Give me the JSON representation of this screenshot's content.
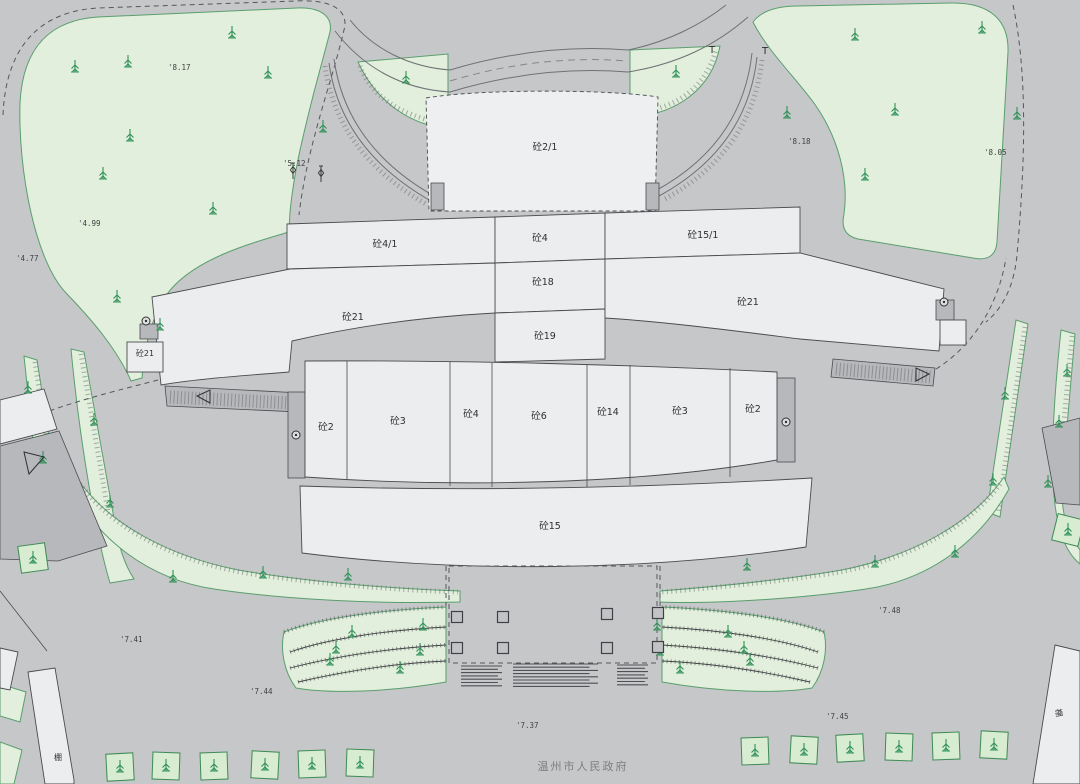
{
  "map": {
    "footer": "温州市人民政府",
    "labels": {
      "b2_1": "砼2/1",
      "b4_1": "砼4/1",
      "b4_top": "砼4",
      "b15_1": "砼15/1",
      "b18": "砼18",
      "b19": "砼19",
      "b21_left": "砼21",
      "b21_right": "砼21",
      "b21_small": "砼21",
      "b2_row_left": "砼2",
      "b3_row_left": "砼3",
      "b4_row": "砼4",
      "b6_row": "砼6",
      "b14_row": "砼14",
      "b3_row_right": "砼3",
      "b2_row_right": "砼2",
      "b15": "砼15",
      "shed_left": "棚",
      "shed_right": "棚"
    },
    "elevations": [
      {
        "text": "'8.17",
        "x": 168,
        "y": 70
      },
      {
        "text": "'5.12",
        "x": 283,
        "y": 166
      },
      {
        "text": "'4.99",
        "x": 78,
        "y": 226
      },
      {
        "text": "'4.77",
        "x": 16,
        "y": 261
      },
      {
        "text": "'8.18",
        "x": 788,
        "y": 144
      },
      {
        "text": "'8.05",
        "x": 984,
        "y": 155
      },
      {
        "text": "'7.48",
        "x": 878,
        "y": 613
      },
      {
        "text": "'7.41",
        "x": 120,
        "y": 642
      },
      {
        "text": "'7.44",
        "x": 250,
        "y": 694
      },
      {
        "text": "'7.37",
        "x": 516,
        "y": 728
      },
      {
        "text": "'7.45",
        "x": 826,
        "y": 719
      }
    ],
    "t_markers": [
      {
        "text": "T",
        "x": 712,
        "y": 53
      },
      {
        "text": "T",
        "x": 765,
        "y": 54
      }
    ],
    "trees": [
      [
        75,
        67
      ],
      [
        128,
        62
      ],
      [
        232,
        33
      ],
      [
        268,
        73
      ],
      [
        130,
        136
      ],
      [
        103,
        174
      ],
      [
        213,
        209
      ],
      [
        160,
        325
      ],
      [
        117,
        297
      ],
      [
        323,
        127
      ],
      [
        406,
        78
      ],
      [
        676,
        72
      ],
      [
        855,
        35
      ],
      [
        982,
        28
      ],
      [
        787,
        113
      ],
      [
        895,
        110
      ],
      [
        1017,
        114
      ],
      [
        865,
        175
      ],
      [
        28,
        388
      ],
      [
        43,
        458
      ],
      [
        94,
        420
      ],
      [
        110,
        502
      ],
      [
        1005,
        394
      ],
      [
        1067,
        371
      ],
      [
        1059,
        422
      ],
      [
        1048,
        482
      ],
      [
        993,
        480
      ],
      [
        173,
        577
      ],
      [
        263,
        573
      ],
      [
        348,
        575
      ],
      [
        747,
        565
      ],
      [
        875,
        562
      ],
      [
        955,
        552
      ],
      [
        352,
        632
      ],
      [
        423,
        625
      ],
      [
        336,
        648
      ],
      [
        330,
        660
      ],
      [
        420,
        650
      ],
      [
        400,
        668
      ],
      [
        728,
        632
      ],
      [
        657,
        625
      ],
      [
        744,
        648
      ],
      [
        750,
        660
      ],
      [
        660,
        650
      ],
      [
        680,
        668
      ]
    ],
    "stakes": [
      [
        293,
        172
      ],
      [
        321,
        175
      ]
    ],
    "circles": [
      [
        146,
        321
      ],
      [
        944,
        302
      ],
      [
        296,
        435
      ],
      [
        786,
        422
      ]
    ],
    "arrows": [
      {
        "points": "210,390 210,403 197,396"
      },
      {
        "points": "916,368 916,381 929,374"
      },
      {
        "points": "24,452 44,457 29,474"
      }
    ],
    "plaza_squares": [
      [
        457,
        617
      ],
      [
        503,
        617
      ],
      [
        607,
        614
      ],
      [
        658,
        613
      ],
      [
        457,
        648
      ],
      [
        503,
        648
      ],
      [
        607,
        648
      ],
      [
        658,
        647
      ]
    ],
    "steps": [
      {
        "x": 461,
        "y": 666,
        "w": 41,
        "n": 7,
        "s": 3.3
      },
      {
        "x": 513,
        "y": 664,
        "w": 85,
        "n": 8,
        "s": 3.2
      },
      {
        "x": 617,
        "y": 665,
        "w": 31,
        "n": 7,
        "s": 3.3
      }
    ],
    "planters": {
      "size": 27,
      "items": [
        [
          120,
          767,
          -3
        ],
        [
          166,
          766,
          2
        ],
        [
          214,
          766,
          -2
        ],
        [
          265,
          765,
          3
        ],
        [
          312,
          764,
          -2
        ],
        [
          360,
          763,
          2
        ],
        [
          755,
          751,
          -2
        ],
        [
          804,
          750,
          3
        ],
        [
          850,
          748,
          -3
        ],
        [
          899,
          747,
          2
        ],
        [
          946,
          746,
          -2
        ],
        [
          994,
          745,
          3
        ],
        [
          33,
          558,
          -8
        ],
        [
          1068,
          530,
          14
        ]
      ]
    },
    "colors": {
      "background": "#c6c7c9",
      "green": "#e2efdc",
      "green_border": "#5a9e6e",
      "building": "#ebedef",
      "mid_gray": "#b7b8bb",
      "line": "#4a4c4f",
      "tree": "#2f9158",
      "text": "#2e2f31",
      "footer_text": "#7d7e81"
    }
  }
}
